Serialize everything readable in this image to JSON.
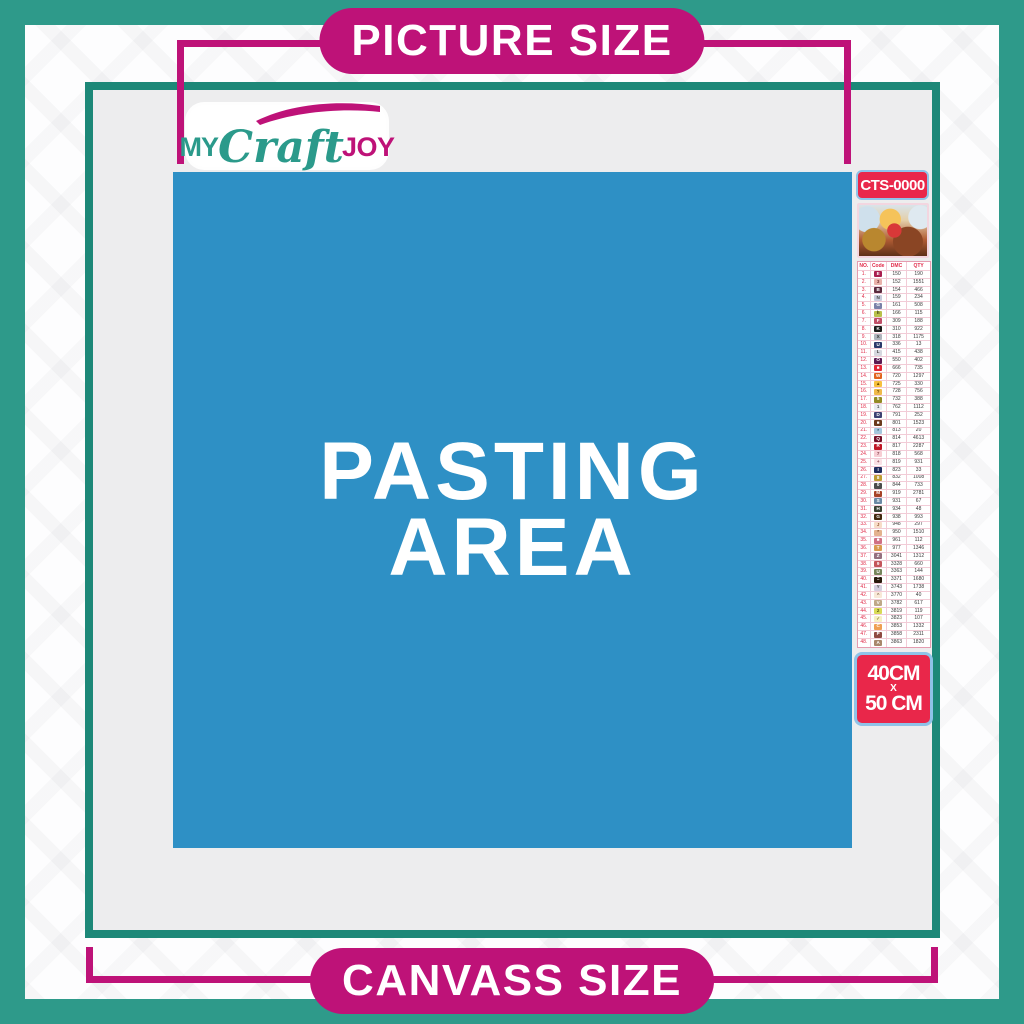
{
  "banners": {
    "top": "PICTURE SIZE",
    "bottom": "CANVASS SIZE"
  },
  "logo": {
    "part1": "MY",
    "part2": "Craft",
    "part3": "JOY"
  },
  "pasting_area": {
    "line1": "PASTING",
    "line2": "AREA"
  },
  "product": {
    "code": "CTS-0000",
    "thumbnail": "santa-sleigh-christmas-scene"
  },
  "size_badge": {
    "line1": "40CM",
    "line2": "X",
    "line3": "50 CM"
  },
  "colors": {
    "outer_teal": "#2e9a8a",
    "frame_teal": "#1d8878",
    "magenta": "#be1278",
    "pasting_blue": "#2e90c5",
    "badge_red": "#e9274a",
    "badge_border_blue": "#8fc3e8",
    "canvas_gray": "#ededee",
    "table_line_pink": "#e59cb0",
    "table_red": "#e02a48"
  },
  "legend": {
    "headers": [
      "NO.",
      "Code",
      "DMC",
      "QTY"
    ],
    "rows": [
      {
        "no": "1.",
        "sym": "E",
        "dmc": "150",
        "qty": "190",
        "bg": "#a91e50",
        "fg": "#ffffff"
      },
      {
        "no": "2.",
        "sym": "3",
        "dmc": "152",
        "qty": "1551",
        "bg": "#e9b2ab",
        "fg": "#7a3b3b"
      },
      {
        "no": "3.",
        "sym": "B",
        "dmc": "154",
        "qty": "466",
        "bg": "#5a2a3e",
        "fg": "#ffffff"
      },
      {
        "no": "4.",
        "sym": "N",
        "dmc": "159",
        "qty": "234",
        "bg": "#c9cbdc",
        "fg": "#444444"
      },
      {
        "no": "5.",
        "sym": "G",
        "dmc": "161",
        "qty": "508",
        "bg": "#7a81a8",
        "fg": "#ffffff"
      },
      {
        "no": "6.",
        "sym": "h",
        "dmc": "166",
        "qty": "115",
        "bg": "#b9c14b",
        "fg": "#3c3c13"
      },
      {
        "no": "7.",
        "sym": "F",
        "dmc": "309",
        "qty": "188",
        "bg": "#c04e67",
        "fg": "#ffffff"
      },
      {
        "no": "8.",
        "sym": "K",
        "dmc": "310",
        "qty": "922",
        "bg": "#1a1a1a",
        "fg": "#ffffff"
      },
      {
        "no": "9.",
        "sym": "X",
        "dmc": "318",
        "qty": "1175",
        "bg": "#b0b4bd",
        "fg": "#333333"
      },
      {
        "no": "10.",
        "sym": "U",
        "dmc": "336",
        "qty": "13",
        "bg": "#2b3a6b",
        "fg": "#ffffff"
      },
      {
        "no": "11.",
        "sym": "L",
        "dmc": "415",
        "qty": "438",
        "bg": "#d6d8df",
        "fg": "#444444"
      },
      {
        "no": "12.",
        "sym": "O",
        "dmc": "550",
        "qty": "402",
        "bg": "#5b1a52",
        "fg": "#ffffff"
      },
      {
        "no": "13.",
        "sym": "■",
        "dmc": "666",
        "qty": "735",
        "bg": "#e32636",
        "fg": "#ffffff"
      },
      {
        "no": "14.",
        "sym": "W",
        "dmc": "720",
        "qty": "1297",
        "bg": "#e2631f",
        "fg": "#ffffff"
      },
      {
        "no": "15.",
        "sym": "▲",
        "dmc": "725",
        "qty": "330",
        "bg": "#f7c03e",
        "fg": "#6b4a00"
      },
      {
        "no": "16.",
        "sym": "?",
        "dmc": "728",
        "qty": "756",
        "bg": "#f0b94b",
        "fg": "#6b4a00"
      },
      {
        "no": "17.",
        "sym": "5",
        "dmc": "732",
        "qty": "388",
        "bg": "#938a24",
        "fg": "#ffffff"
      },
      {
        "no": "18.",
        "sym": "1",
        "dmc": "762",
        "qty": "1112",
        "bg": "#e9eaee",
        "fg": "#555555"
      },
      {
        "no": "19.",
        "sym": "D",
        "dmc": "791",
        "qty": "252",
        "bg": "#3e4273",
        "fg": "#ffffff"
      },
      {
        "no": "20.",
        "sym": "■",
        "dmc": "801",
        "qty": "1523",
        "bg": "#6b3a1d",
        "fg": "#ffffff"
      },
      {
        "no": "21.",
        "sym": "*",
        "dmc": "813",
        "qty": "20",
        "bg": "#a4c6dd",
        "fg": "#2a4a66"
      },
      {
        "no": "22.",
        "sym": "Q",
        "dmc": "814",
        "qty": "4613",
        "bg": "#750f28",
        "fg": "#ffffff"
      },
      {
        "no": "23.",
        "sym": "R",
        "dmc": "817",
        "qty": "2287",
        "bg": "#c01626",
        "fg": "#ffffff"
      },
      {
        "no": "24.",
        "sym": "7",
        "dmc": "818",
        "qty": "568",
        "bg": "#f7cdd4",
        "fg": "#8a4a55"
      },
      {
        "no": "25.",
        "sym": "+",
        "dmc": "819",
        "qty": "931",
        "bg": "#f9e0e4",
        "fg": "#8a4a55"
      },
      {
        "no": "26.",
        "sym": "I",
        "dmc": "823",
        "qty": "33",
        "bg": "#1f2d5e",
        "fg": "#ffffff"
      },
      {
        "no": "27.",
        "sym": "8",
        "dmc": "832",
        "qty": "1008",
        "bg": "#bd9b33",
        "fg": "#ffffff"
      },
      {
        "no": "28.",
        "sym": "0",
        "dmc": "844",
        "qty": "733",
        "bg": "#4c4c4c",
        "fg": "#ffffff"
      },
      {
        "no": "29.",
        "sym": "M",
        "dmc": "919",
        "qty": "2781",
        "bg": "#a64227",
        "fg": "#ffffff"
      },
      {
        "no": "30.",
        "sym": "S",
        "dmc": "931",
        "qty": "67",
        "bg": "#6b89a5",
        "fg": "#ffffff"
      },
      {
        "no": "31.",
        "sym": "H",
        "dmc": "934",
        "qty": "48",
        "bg": "#3a4032",
        "fg": "#ffffff"
      },
      {
        "no": "32.",
        "sym": "G",
        "dmc": "938",
        "qty": "993",
        "bg": "#43280f",
        "fg": "#ffffff"
      },
      {
        "no": "33.",
        "sym": "J",
        "dmc": "948",
        "qty": "297",
        "bg": "#f7dcc8",
        "fg": "#9a5c3a"
      },
      {
        "no": "34.",
        "sym": "*",
        "dmc": "950",
        "qty": "1510",
        "bg": "#e3b28e",
        "fg": "#7a4a2a"
      },
      {
        "no": "35.",
        "sym": "■",
        "dmc": "961",
        "qty": "112",
        "bg": "#cf7084",
        "fg": "#ffffff"
      },
      {
        "no": "36.",
        "sym": "T",
        "dmc": "977",
        "qty": "1346",
        "bg": "#d99a4e",
        "fg": "#ffffff"
      },
      {
        "no": "37.",
        "sym": "Z",
        "dmc": "3041",
        "qty": "1312",
        "bg": "#95707f",
        "fg": "#ffffff"
      },
      {
        "no": "38.",
        "sym": "9",
        "dmc": "3328",
        "qty": "660",
        "bg": "#c4565c",
        "fg": "#ffffff"
      },
      {
        "no": "39.",
        "sym": "U",
        "dmc": "3363",
        "qty": "144",
        "bg": "#77855c",
        "fg": "#ffffff"
      },
      {
        "no": "40.",
        "sym": "=",
        "dmc": "3371",
        "qty": "1680",
        "bg": "#2a1a0d",
        "fg": "#ffffff"
      },
      {
        "no": "41.",
        "sym": "Y",
        "dmc": "3743",
        "qty": "1738",
        "bg": "#d5cede",
        "fg": "#555555"
      },
      {
        "no": "42.",
        "sym": "^",
        "dmc": "3770",
        "qty": "40",
        "bg": "#f8e8d8",
        "fg": "#8a6a4a"
      },
      {
        "no": "43.",
        "sym": "V",
        "dmc": "3782",
        "qty": "617",
        "bg": "#bfa888",
        "fg": "#ffffff"
      },
      {
        "no": "44.",
        "sym": "2",
        "dmc": "3819",
        "qty": "119",
        "bg": "#d8da56",
        "fg": "#5a5a14"
      },
      {
        "no": "45.",
        "sym": "✓",
        "dmc": "3823",
        "qty": "107",
        "bg": "#f7f0c5",
        "fg": "#8a7a2a"
      },
      {
        "no": "46.",
        "sym": "C",
        "dmc": "3853",
        "qty": "1332",
        "bg": "#ef9f53",
        "fg": "#ffffff"
      },
      {
        "no": "47.",
        "sym": "P",
        "dmc": "3858",
        "qty": "2311",
        "bg": "#8f4a42",
        "fg": "#ffffff"
      },
      {
        "no": "48.",
        "sym": "A",
        "dmc": "3863",
        "qty": "1820",
        "bg": "#a8876b",
        "fg": "#ffffff"
      }
    ]
  }
}
